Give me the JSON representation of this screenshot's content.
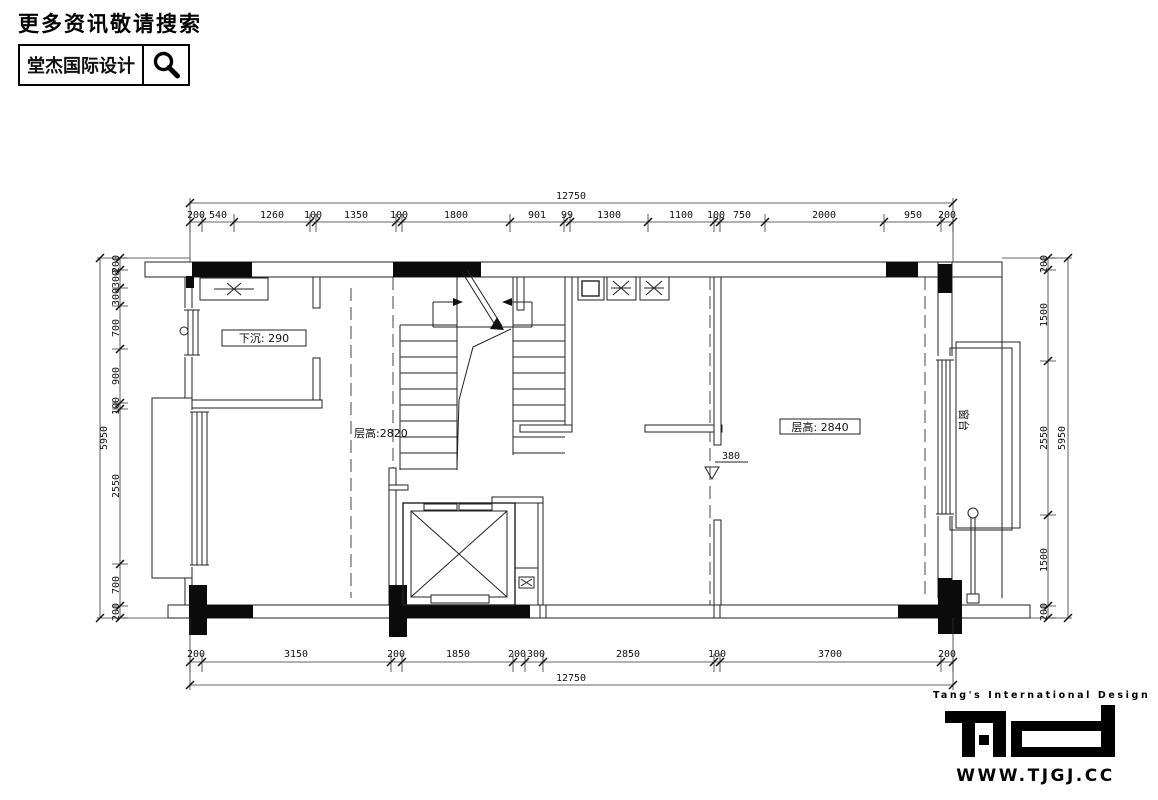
{
  "header": {
    "tagline": "更多资讯敬请搜索",
    "brand": "堂杰国际设计",
    "search_icon": "magnifier-icon"
  },
  "plan": {
    "labels": {
      "sunken_note": "下沉: 290",
      "floor_height_left": "层高:2820",
      "floor_height_right": "层高: 2840",
      "step_height": "380",
      "bay_window": "窗台"
    },
    "dimensions": {
      "top": {
        "overall": "12750",
        "segments": [
          "200",
          "540",
          "1260",
          "100",
          "1350",
          "100",
          "1800",
          "901",
          "99",
          "1300",
          "1100",
          "100",
          "750",
          "2000",
          "950",
          "200"
        ]
      },
      "bottom": {
        "overall": "12750",
        "segments": [
          "200",
          "3150",
          "200",
          "1850",
          "200",
          "300",
          "2850",
          "100",
          "3700",
          "200"
        ]
      },
      "left": {
        "overall": "5950",
        "segments": [
          "200",
          "300",
          "300",
          "700",
          "900",
          "100",
          "2550",
          "700",
          "200"
        ]
      },
      "right": {
        "overall": "5950",
        "segments": [
          "200",
          "1500",
          "2550",
          "1500",
          "200"
        ]
      }
    }
  },
  "footer": {
    "tagline": "Tang's International Design",
    "logo_text": "T.ID",
    "website": "WWW.TJGJ.CC"
  }
}
